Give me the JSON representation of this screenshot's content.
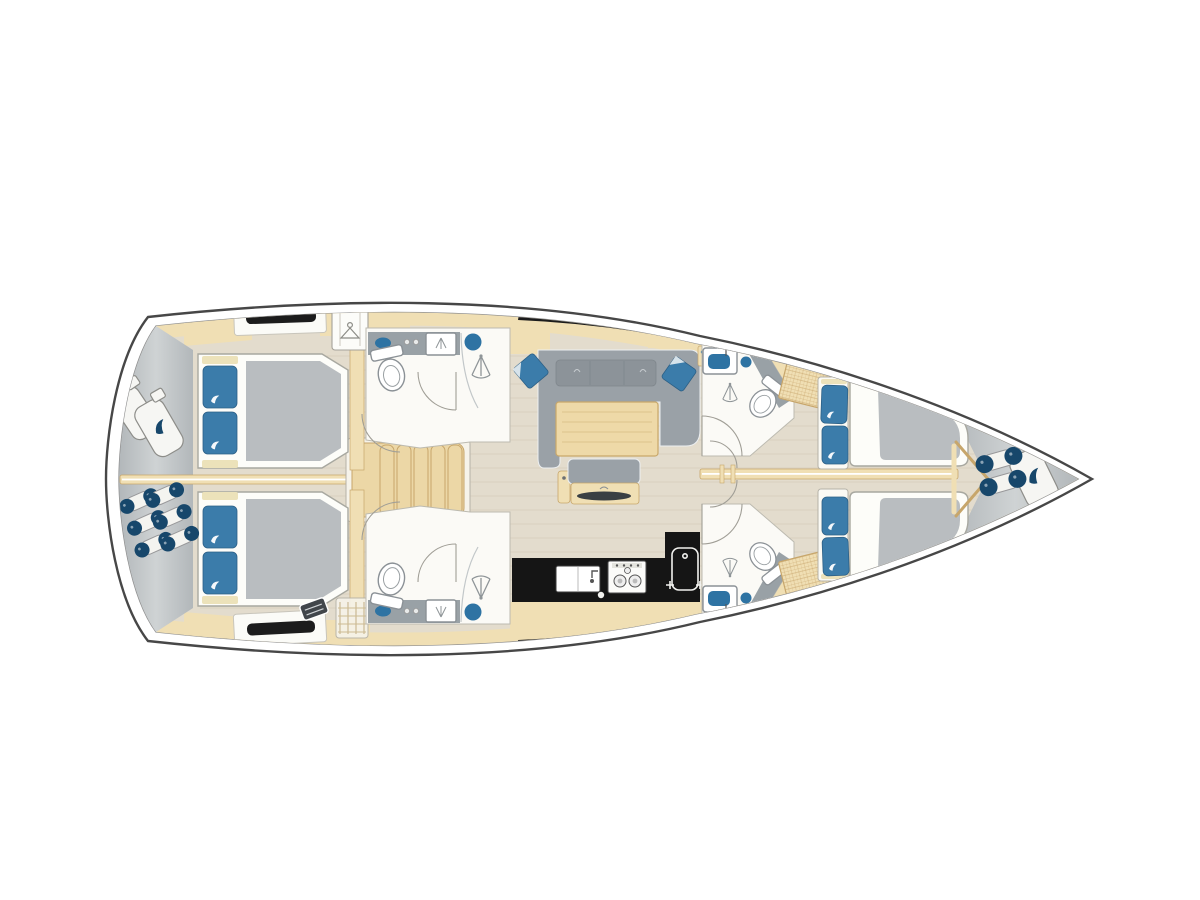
{
  "colors": {
    "background": "#ffffff",
    "hull_stroke": "#474747",
    "hull_inner_stroke": "#909090",
    "floor": "#e3dccd",
    "floor_grain": "#cdc3ab",
    "deck_light": "#cfd3d4",
    "deck": "#b2b7ba",
    "wood": "#f0dfb4",
    "wood_dark": "#c7a66b",
    "stair_wood": "#ecd7a6",
    "room_white": "#fbfaf6",
    "counter_gray": "#99a1a6",
    "sofa_gray": "#9aa1a7",
    "cushion_gray": "#8c9399",
    "mattress_gray": "#b9bdc0",
    "pillow_blue": "#3b7caa",
    "accent_blue": "#2e73a3",
    "navy": "#17476b",
    "cream": "#ece2ba",
    "galley_black": "#151515",
    "window_black": "#1c1c1c",
    "fixture_stroke": "#8b9196",
    "glass_line": "#c2c7c9"
  },
  "icons": {
    "brand_swirl_icon": "swirl",
    "hanger_icon": "hanger",
    "shower_icon": "spray-fan",
    "faucet_icon": "tap",
    "burner_icon": "rings"
  }
}
